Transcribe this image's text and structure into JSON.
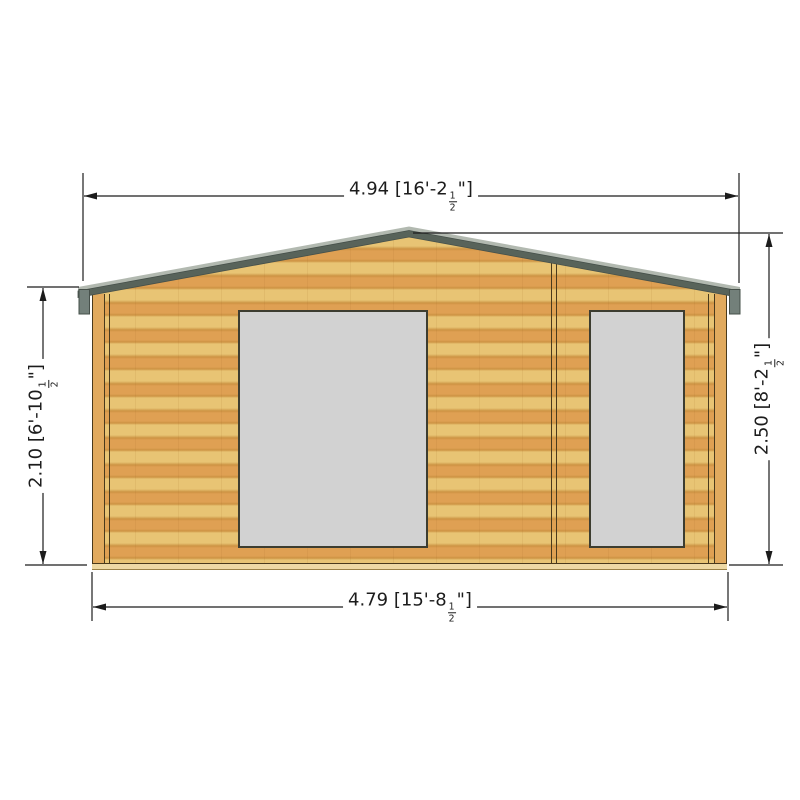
{
  "colors": {
    "background": "#ffffff",
    "wood_light": "#e8c474",
    "wood_dark": "#dfa053",
    "wood_seam": "#cd9343",
    "wall_edge": "#4a3a1c",
    "corner_strip": "#e1aa5e",
    "floor_strip": "#eed9a4",
    "floor_edge": "#9a8147",
    "roof_dark": "#58635a",
    "roof_light": "#b2b9b0",
    "fascia": "#73807a",
    "fascia_edge": "#46504a",
    "panel_fill": "#d2d2d2",
    "panel_border": "#3d3d30",
    "dim": "#1c1c1c"
  },
  "dimensions": {
    "top": {
      "full": "4.94 [16'-2½\"]",
      "metric": "4.94",
      "main": "4.94 [16'-2",
      "frac_num": "1",
      "frac_den": "2",
      "tail": "\"]"
    },
    "bottom": {
      "full": "4.79 [15'-8½\"]",
      "metric": "4.79",
      "main": "4.79 [15'-8",
      "frac_num": "1",
      "frac_den": "2",
      "tail": "\"]"
    },
    "left": {
      "full": "2.10 [6'-10½\"]",
      "metric": "2.10",
      "main": "2.10 [6'-10",
      "frac_num": "1",
      "frac_den": "2",
      "tail": "\"]"
    },
    "right": {
      "full": "2.50 [8'-2½\"]",
      "metric": "2.50",
      "main": "2.50 [8'-2",
      "frac_num": "1",
      "frac_den": "2",
      "tail": "\"]"
    }
  }
}
